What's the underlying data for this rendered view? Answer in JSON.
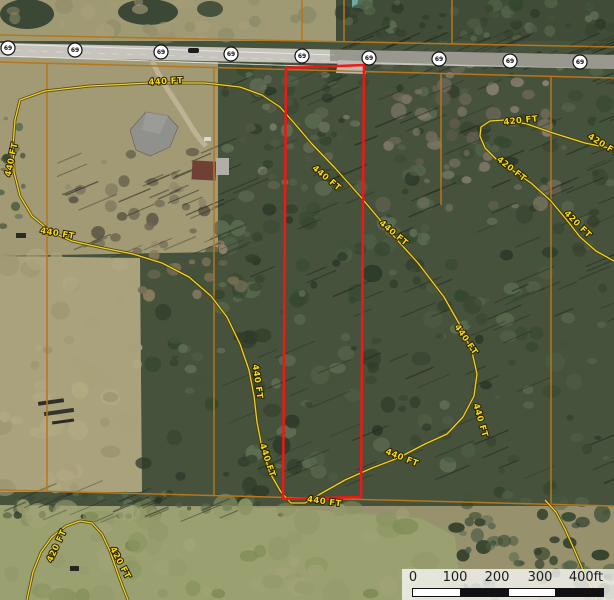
{
  "map": {
    "description": "Aerial parcel map with elevation contours, highway 69 route markers, property lines and a red-outlined survey parcel",
    "route_shields": {
      "label": "69",
      "count": 9
    },
    "contour_labels": [
      {
        "text": "440 FT",
        "x": 166,
        "y": 84,
        "rot": -3
      },
      {
        "text": "440 FT",
        "x": 14,
        "y": 160,
        "rot": -78
      },
      {
        "text": "440 FT",
        "x": 57,
        "y": 236,
        "rot": 10
      },
      {
        "text": "440 FT",
        "x": 325,
        "y": 180,
        "rot": 40
      },
      {
        "text": "440 FT",
        "x": 392,
        "y": 235,
        "rot": 40
      },
      {
        "text": "440 FT",
        "x": 464,
        "y": 341,
        "rot": 56
      },
      {
        "text": "440 FT",
        "x": 478,
        "y": 421,
        "rot": 74
      },
      {
        "text": "440 FT",
        "x": 401,
        "y": 460,
        "rot": 22
      },
      {
        "text": "440 FT",
        "x": 255,
        "y": 382,
        "rot": 82
      },
      {
        "text": "440 FT",
        "x": 265,
        "y": 461,
        "rot": 72
      },
      {
        "text": "440 FT",
        "x": 324,
        "y": 504,
        "rot": 8
      },
      {
        "text": "420 FT",
        "x": 521,
        "y": 123,
        "rot": -6
      },
      {
        "text": "420 FT",
        "x": 602,
        "y": 147,
        "rot": 32
      },
      {
        "text": "420 FT",
        "x": 510,
        "y": 171,
        "rot": 38
      },
      {
        "text": "420 FT",
        "x": 576,
        "y": 226,
        "rot": 45
      },
      {
        "text": "420 FT",
        "x": 59,
        "y": 547,
        "rot": -65
      },
      {
        "text": "420 FT",
        "x": 118,
        "y": 564,
        "rot": 62
      }
    ],
    "scale_bar": {
      "labels": [
        "0",
        "100",
        "200",
        "300",
        "400ft"
      ]
    },
    "colors": {
      "parcel_outline": "#f21616",
      "property_line": "#b5761c",
      "contour_core": "#ecd12f",
      "contour_casing": "#4a3c05",
      "road_surface": "#c6c4bd",
      "shield_fill": "#ffffff"
    }
  }
}
